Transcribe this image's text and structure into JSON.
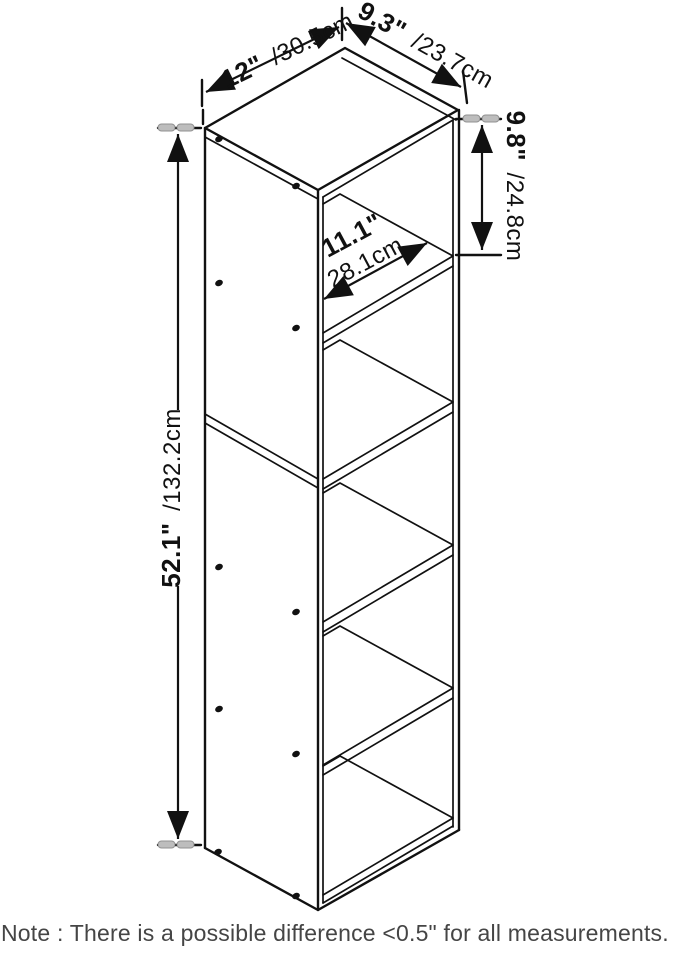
{
  "diagram": {
    "dims": {
      "width": {
        "in": "12\"",
        "cm": "/30.5cm"
      },
      "depth": {
        "in": "9.3\"",
        "cm": "/23.7cm"
      },
      "cubby": {
        "in": "9.8\"",
        "cm": "/24.8cm"
      },
      "height": {
        "in": "52.1\"",
        "cm": "/132.2cm"
      },
      "interior": {
        "in": "11.1\"",
        "cm": "28.1cm"
      }
    },
    "note": "Note : There is a possible difference <0.5\" for all measurements.",
    "colors": {
      "line": "#111111",
      "tick_highlight": "#bdbdbd",
      "note_text": "#454545",
      "background": "#ffffff"
    }
  }
}
